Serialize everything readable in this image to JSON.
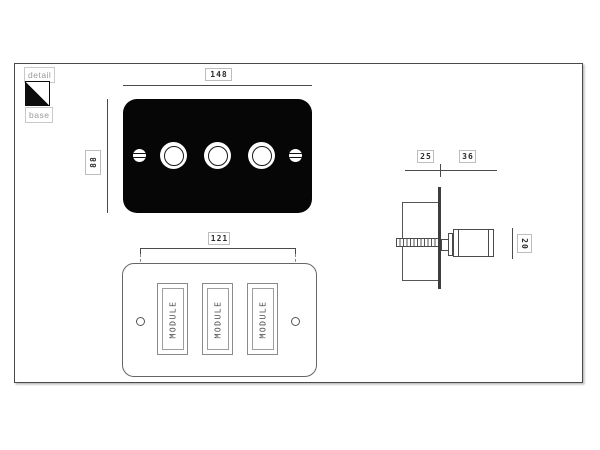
{
  "legend": {
    "detail": "detail",
    "base": "base"
  },
  "detail_view": {
    "plate_width": "148",
    "plate_height": "88",
    "knob_count": 3
  },
  "base_view": {
    "fixing_centres": "121",
    "modules": [
      {
        "label": "MODULE"
      },
      {
        "label": "MODULE"
      },
      {
        "label": "MODULE"
      }
    ]
  },
  "side_view": {
    "box_depth": "25",
    "knob_projection": "36",
    "knob_diameter": "20"
  },
  "icons": {
    "legend_swatch": "detail-base-diagonal-swatch-icon"
  },
  "colors": {
    "plate_fill": "#060606",
    "line": "#4a4a4a",
    "outline_gray": "#666666",
    "label_border": "#bdbdbd",
    "label_text": "#2b2b2b",
    "legend_text": "#9a9a9a",
    "background": "#ffffff"
  }
}
